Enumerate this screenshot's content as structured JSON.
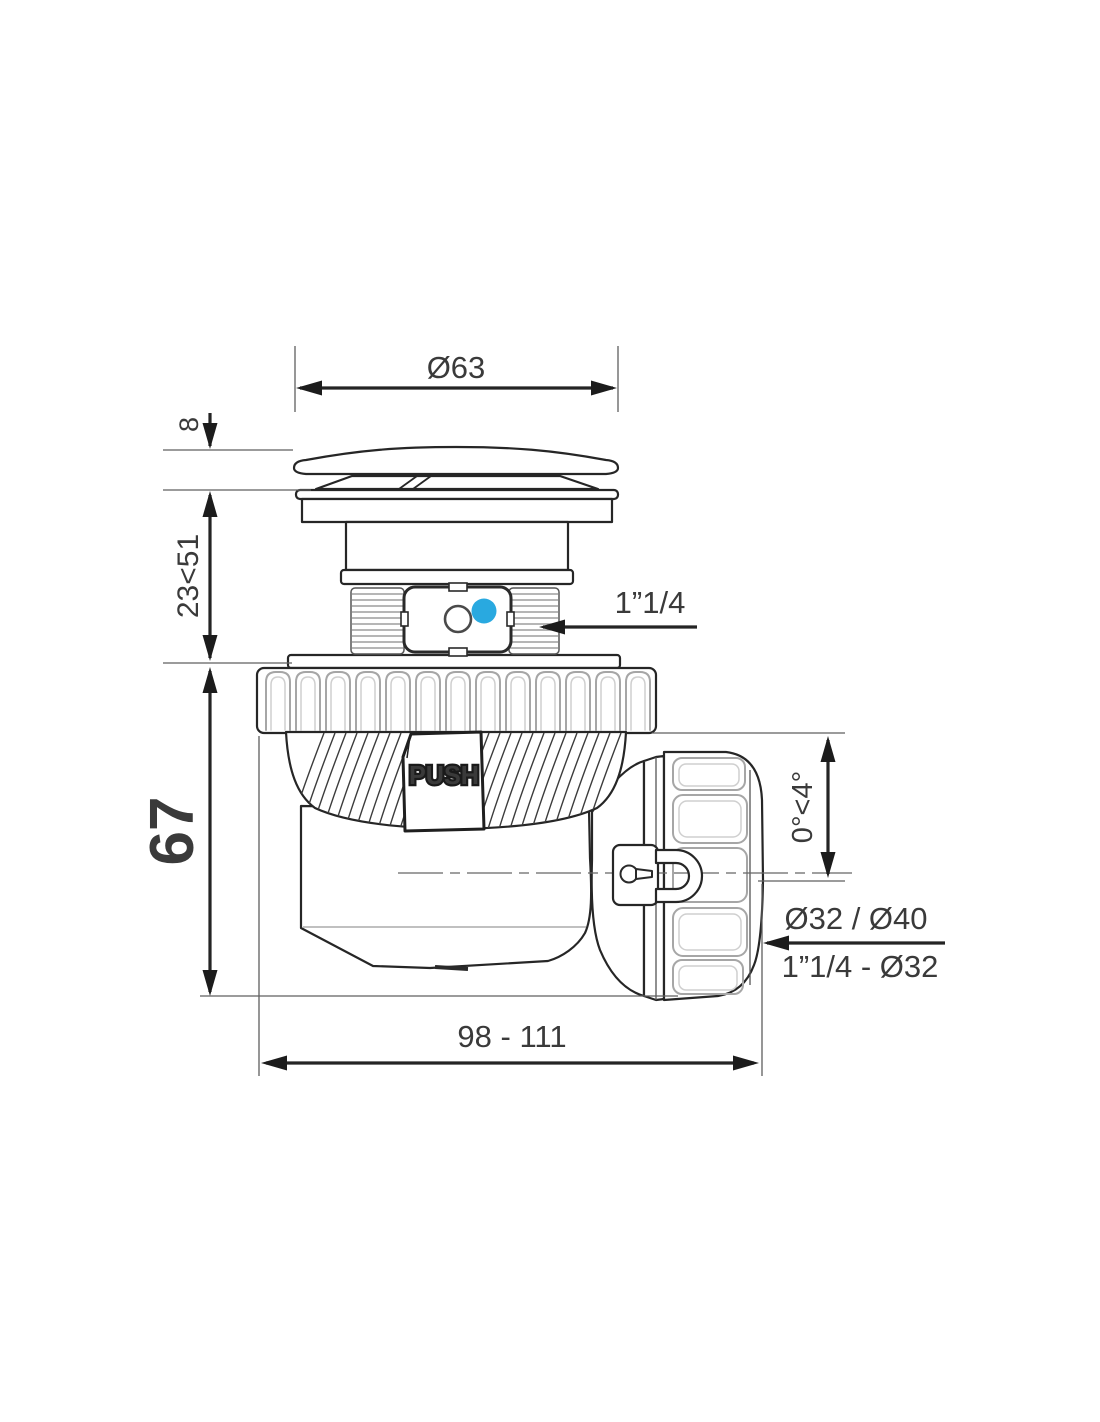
{
  "drawing": {
    "kind": "technical-drawing",
    "colors": {
      "accent_blue": "#29A9E0",
      "line": "#262626",
      "rib_gray": "#a6a6a6",
      "text": "#3a3a3a"
    },
    "dims": {
      "cap_diameter": "Ø63",
      "cap_height": "8",
      "height_adjust": "23<51",
      "body_height": "67",
      "inlet_thread": "1”1/4",
      "outlet_angle": "0°<4°",
      "outlet_sizes": "Ø32 / Ø40",
      "outlet_reduction": "1”1/4 - Ø32",
      "overall_length": "98 - 111"
    },
    "labels": {
      "push": "PUSH"
    }
  }
}
